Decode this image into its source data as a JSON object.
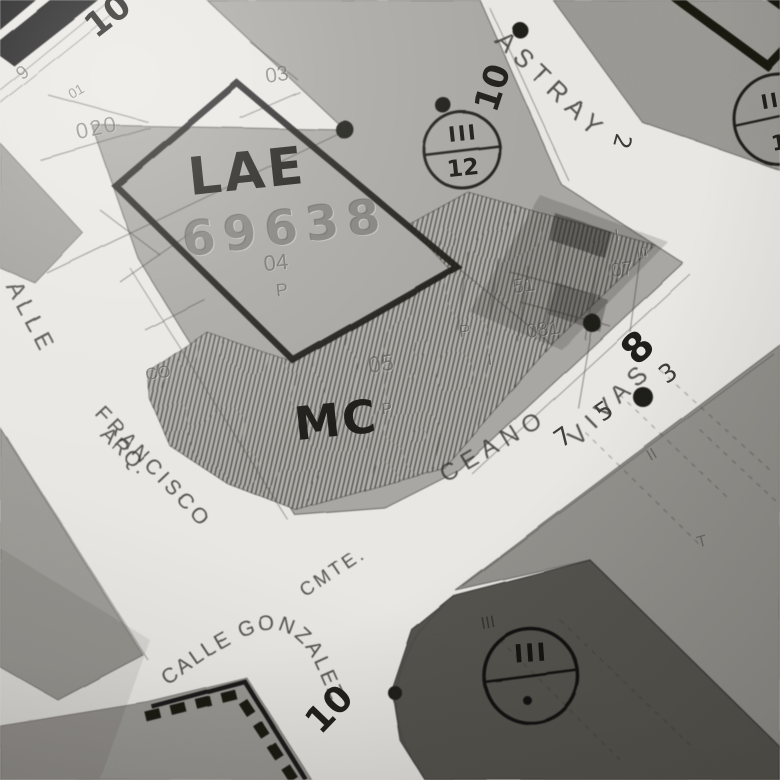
{
  "zones": {
    "lae": "LAE",
    "lae_parcel_number": "69638",
    "mc": "MC"
  },
  "zone_markers": {
    "m12_top": "III",
    "m12_bottom": "12",
    "tr_top": "III",
    "tr_bottom": "12",
    "br_top": "III",
    "br_bottom": "·"
  },
  "streets": {
    "alle": "ALLE",
    "arq": "ARQ.",
    "francisco": "FRANCISCO",
    "cmte": "CMTE.",
    "ceano": "CEANO",
    "vivas": "VIVAS",
    "calle_gonzalez": "CALLE GONZALEZ",
    "astray": "ASTRAY",
    "astray_no": "2"
  },
  "street_widths": {
    "w10_topleft": "10",
    "w10_astray": "10",
    "w10_gonzalez": "10",
    "w8": "8"
  },
  "house_numbers": {
    "h7": "7",
    "h5": "5",
    "h3": "3"
  },
  "parcel_codes": {
    "c9": "9",
    "c01": "01",
    "c020": "020",
    "c03": "03",
    "c04": "04",
    "cp1": "P",
    "cp2": "P",
    "cp3": "P",
    "cco": "CO",
    "c05": "05",
    "c51": "51",
    "c081": "081",
    "c07": "07",
    "ci1": "I",
    "ciii_small": "III",
    "ci2": "I",
    "ciii_dark": "III",
    "cii": "II",
    "ct": "T"
  },
  "colors": {
    "paper": "#eae8e4",
    "block_gray": "#a9a7a3",
    "dark_block": "#53514c",
    "hatch_line": "#504e49",
    "ink": "#1c1b18",
    "faint_ink": "#5e5c57"
  }
}
